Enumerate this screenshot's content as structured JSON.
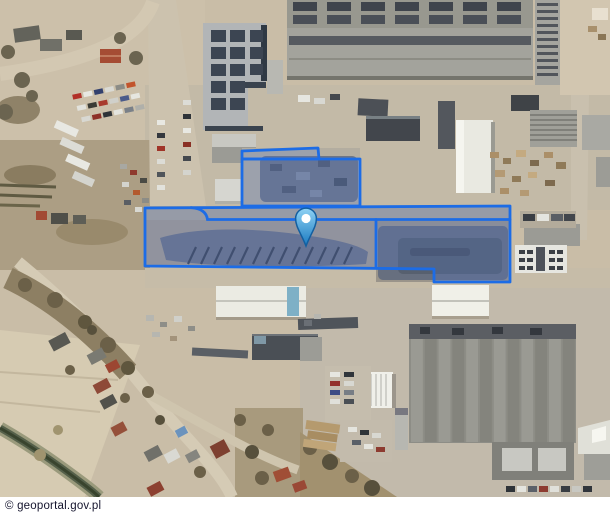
{
  "map": {
    "attribution": "© geoportal.gov.pl",
    "overlay": {
      "stroke_color": "#1c6ce6",
      "fill_color": "rgba(77,118,214,0.22)",
      "parcels": {
        "north_sliver_points": "242,151 318,148 319,159 242,159",
        "north_parcel_points": "242,159 360,159 360,206 242,206",
        "main_parcel_points": "145,208 510,206 510,282 434,282 434,269 145,266",
        "inner_boundary_path": "M 191 207.6 Q 206 208.6 207.5 219.5 L 510 219.5",
        "inner_divider_points": "376,219.5 376,267.5"
      }
    },
    "marker": {
      "label": "location-pin",
      "map_x": 306,
      "map_y": 208,
      "transform": "translate(306,208)",
      "color_top": "#8fd2f4",
      "color_bottom": "#1a7ac1",
      "outline_color": "#135fa0",
      "dot_color": "#ffffff"
    }
  }
}
